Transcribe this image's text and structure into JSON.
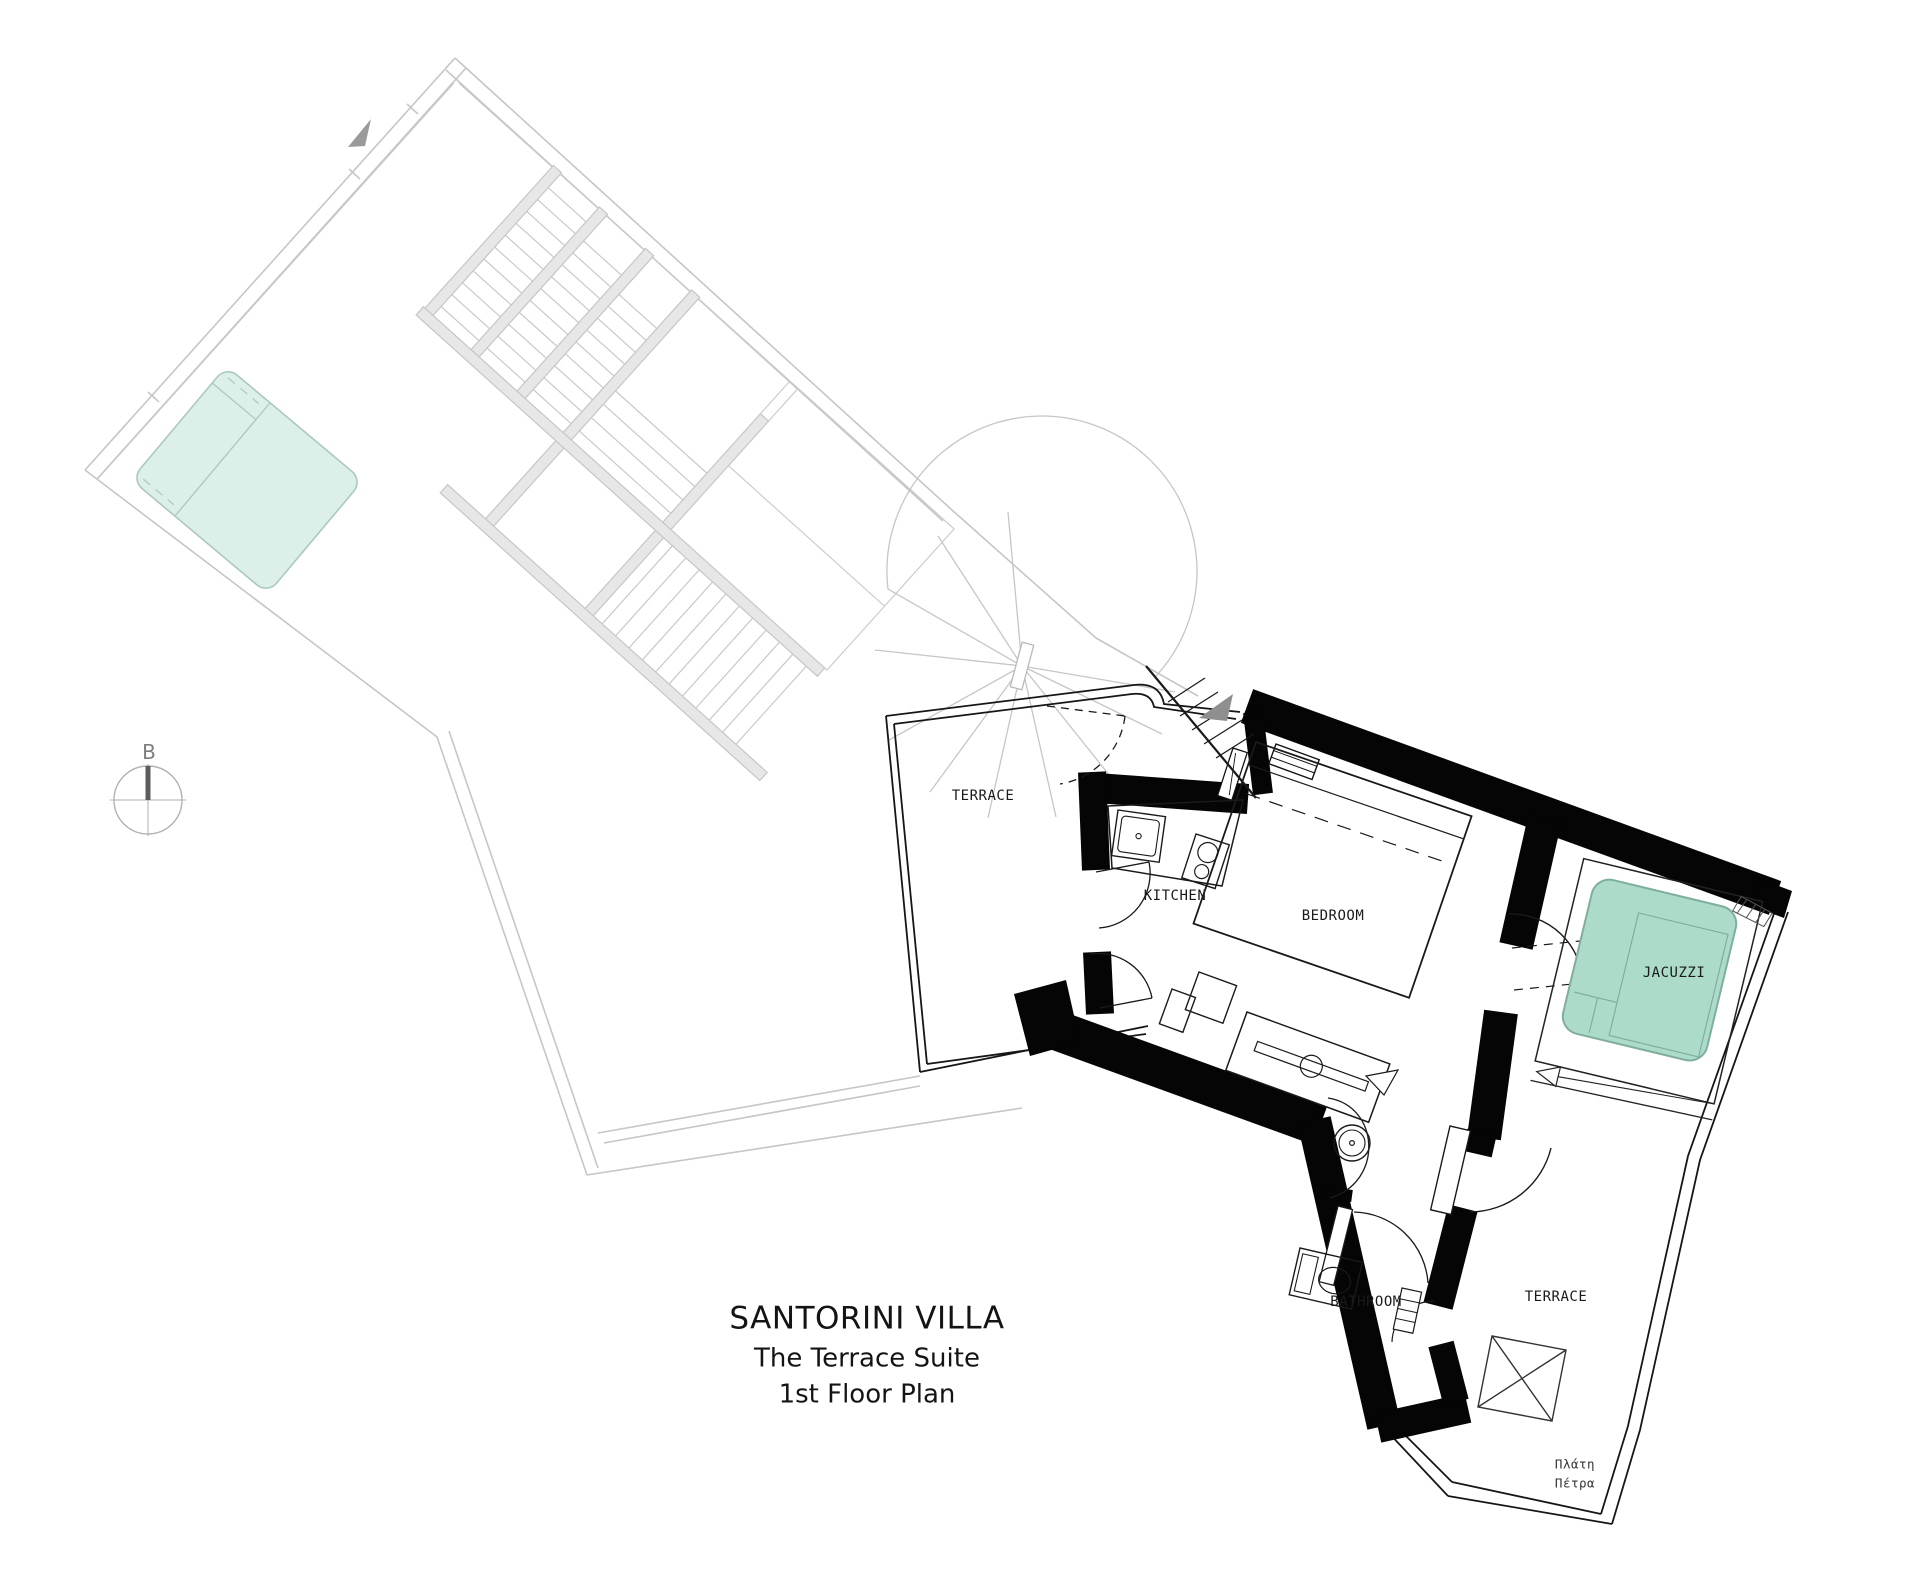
{
  "title_block": {
    "line1": "SANTORINI VILLA",
    "line2": "The Terrace Suite",
    "line3": "1st Floor Plan"
  },
  "rooms": {
    "terrace_upper": "TERRACE",
    "kitchen": "KITCHEN",
    "bedroom": "BEDROOM",
    "jacuzzi": "JACUZZI",
    "bathroom": "BATHROOM",
    "terrace_lower": "TERRACE"
  },
  "annotations": {
    "compass_label": "B",
    "site_note_line1": "Πλάτη",
    "site_note_line2": "Πέτρα"
  },
  "colors": {
    "wall_black": "#050505",
    "jacuzzi_fill": "#acdcc9",
    "jacuzzi_stroke": "#7fae9d",
    "pool_fill": "#dcefe8",
    "pool_stroke": "#abc9bf",
    "adjacent_gray": "#c6c6c6",
    "beam_fill": "#e7e7e7",
    "arrow_gray": "#9a9a9a"
  }
}
